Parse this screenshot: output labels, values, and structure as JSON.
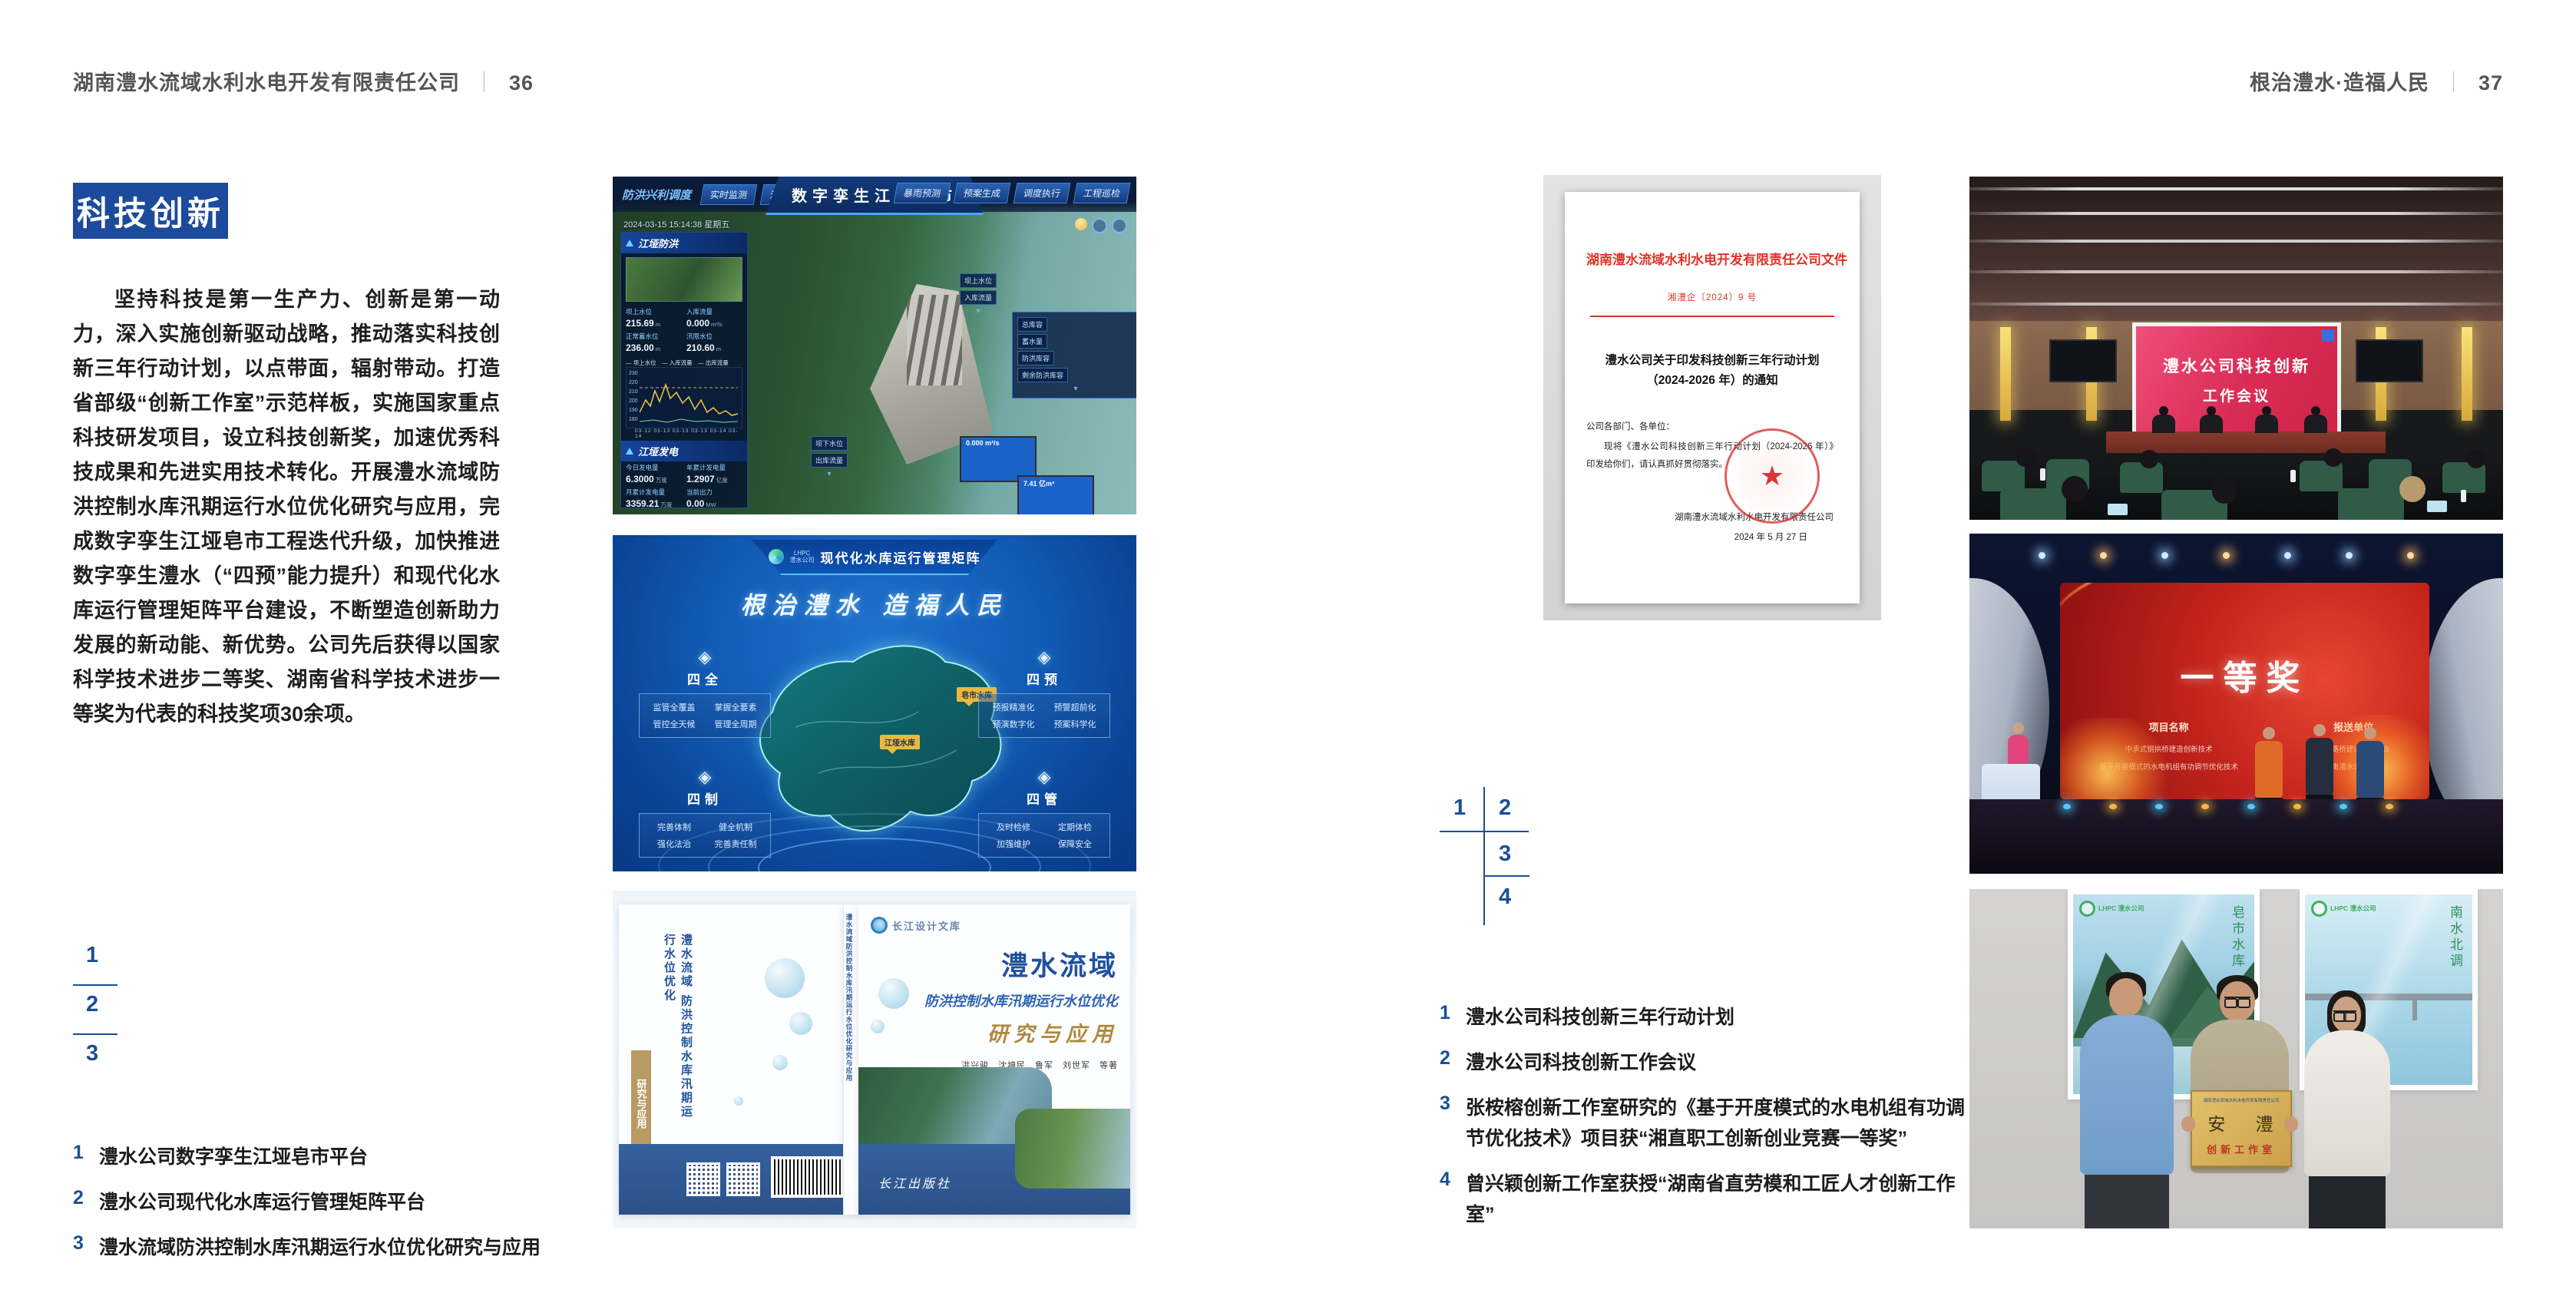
{
  "page": {
    "header_left": {
      "company": "湖南澧水流域水利水电开发有限责任公司",
      "divider": "｜",
      "page_no": "36"
    },
    "header_right": {
      "slogan": "根治澧水·造福人民",
      "divider": "｜",
      "page_no": "37"
    },
    "accent": "#1c4b9d"
  },
  "left_page": {
    "badge": "科技创新",
    "body": "坚持科技是第一生产力、创新是第一动力，深入实施创新驱动战略，推动落实科技创新三年行动计划，以点带面，辐射带动。打造省部级“创新工作室”示范样板，实施国家重点科技研发项目，设立科技创新奖，加速优秀科技成果和先进实用技术转化。开展澧水流域防洪控制水库汛期运行水位优化研究与应用，完成数字孪生江垭皂市工程迭代升级，加快推进数字孪生澧水（“四预”能力提升）和现代化水库运行管理矩阵平台建设，不断塑造创新助力发展的新动能、新优势。公司先后获得以国家科学技术进步二等奖、湖南省科学技术进步一等奖为代表的科技奖项30余项。",
    "index": {
      "n1": "1",
      "n2": "2",
      "n3": "3"
    },
    "captions": [
      {
        "num": "1",
        "text": "澧水公司数字孪生江垭皂市平台"
      },
      {
        "num": "2",
        "text": "澧水公司现代化水库运行管理矩阵平台"
      },
      {
        "num": "3",
        "text": "澧水流域防洪控制水库汛期运行水位优化研究与应用"
      }
    ]
  },
  "right_page": {
    "index": {
      "n1": "1",
      "n2": "2",
      "n3": "3",
      "n4": "4"
    },
    "captions": [
      {
        "num": "1",
        "text": "澧水公司科技创新三年行动计划"
      },
      {
        "num": "2",
        "text": "澧水公司科技创新工作会议"
      },
      {
        "num": "3",
        "text": "张桉榕创新工作室研究的《基于开度模式的水电机组有功调节优化技术》项目获“湘直职工创新创业竞赛一等奖”"
      },
      {
        "num": "4",
        "text": "曾兴颖创新工作室获授“湖南省直劳模和工匠人才创新工作室”"
      }
    ]
  },
  "fig_twin": {
    "title": "数字孪生江垭皂市",
    "mode_label": "防洪兴利调度",
    "nav": [
      "实时监测",
      "洪水预报",
      "防洪预警",
      "暴雨预测",
      "预案生成",
      "调度执行",
      "工程巡检"
    ],
    "datetime": "2024-03-15 15:14:38 星期五",
    "panel_flood_title": "江垭防洪",
    "flood_stats": [
      {
        "label": "坝上水位",
        "value": "215.69",
        "unit": "m"
      },
      {
        "label": "入库流量",
        "value": "0.000",
        "unit": "m³/s"
      },
      {
        "label": "正常蓄水位",
        "value": "236.00",
        "unit": "m"
      },
      {
        "label": "汛限水位",
        "value": "210.60",
        "unit": "m"
      }
    ],
    "legend": "— 坝上水位　— 入库流量　— 出库流量",
    "chart": {
      "y_axis": "230\n220\n210\n200\n190\n180",
      "x_axis": "03-12  03-13  03-13  03-13  03-14  03-14"
    },
    "panel_gen_title": "江垭发电",
    "gen_stats": [
      {
        "label": "今日发电量",
        "value": "6.3000",
        "unit": "万度"
      },
      {
        "label": "年累计发电量",
        "value": "1.2907",
        "unit": "亿度"
      },
      {
        "label": "月累计发电量",
        "value": "3359.21",
        "unit": "万度"
      },
      {
        "label": "当前出力",
        "value": "0.00",
        "unit": "MW"
      }
    ],
    "tag_up": [
      {
        "label": "坝上水位",
        "value": "236.69 m"
      },
      {
        "label": "入库流量",
        "value": "0.000 m³/s"
      }
    ],
    "tag_res": [
      {
        "label": "总库容",
        "value": "17.41 亿m³"
      },
      {
        "label": "蓄水量",
        "value": "8.16 亿m³"
      },
      {
        "label": "防洪库容",
        "value": "7.41 亿m³"
      },
      {
        "label": "剩余防洪库容",
        "value": "7.41 亿m³"
      }
    ],
    "tag_down": [
      {
        "label": "坝下水位",
        "value": "136.78 m"
      },
      {
        "label": "出库流量",
        "value": "65.8 m³/s"
      }
    ]
  },
  "fig_matrix": {
    "logo_text": "LHPC",
    "logo_sub": "澧水公司",
    "title": "现代化水库运行管理矩阵",
    "slogan": "根治澧水 造福人民",
    "groups": [
      {
        "name": "四全",
        "i1": "监管全覆盖",
        "i2": "掌握全要素",
        "i3": "管控全天候",
        "i4": "管理全周期"
      },
      {
        "name": "四预",
        "i1": "预报精准化",
        "i2": "预警超前化",
        "i3": "预演数字化",
        "i4": "预案科学化"
      },
      {
        "name": "四制",
        "i1": "完善体制",
        "i2": "健全机制",
        "i3": "强化法治",
        "i4": "完善责任制"
      },
      {
        "name": "四管",
        "i1": "及时检修",
        "i2": "定期体检",
        "i3": "加强维护",
        "i4": "保障安全"
      }
    ],
    "pin1": "江垭水库",
    "pin2": "皂市水库"
  },
  "fig_book": {
    "series": "长江设计文库",
    "back_title": "澧水流域 防洪控制水库汛期运行水位优化",
    "back_tail": "研究与应用",
    "spine": "澧水流域防洪控制水库汛期运行水位优化研究与应用",
    "title1": "澧水流域",
    "title2": "防洪控制水库汛期运行水位优化",
    "title3": "研究与应用",
    "authors": "洪兴骏　沈坤民　鲁军　刘世军　等著",
    "publisher": "长江出版社"
  },
  "fig_doc": {
    "masthead": "湖南澧水流域水利水电开发有限责任公司文件",
    "doc_no": "湘澧企〔2024〕9 号",
    "title1": "澧水公司关于印发科技创新三年行动计划",
    "title2": "（2024-2026 年）的通知",
    "salutation": "公司各部门、各单位：",
    "body": "现将《澧水公司科技创新三年行动计划（2024-2026 年）》印发给你们，请认真抓好贯彻落实。",
    "signer": "湖南澧水流域水利水电开发有限责任公司",
    "date": "2024 年 5 月 27 日",
    "seal_star": "★"
  },
  "fig_meeting": {
    "screen1": "澧水公司科技创新",
    "screen2": "工作会议"
  },
  "fig_award": {
    "headline": "一等奖",
    "col1_title": "项目名称",
    "col2_title": "报送单位",
    "p1": "中承式钢拱桥建造创新技术",
    "p2": "基于开度模式的水电机组有功调节优化技术",
    "u1": "湖南路桥建设集团工会",
    "u2": "湖南澧水公司工会"
  },
  "fig_studio": {
    "plaque_org": "湖南澧水流域水利水电开发有限责任公司",
    "plaque_name": "安 澧",
    "plaque_sub": "创新工作室",
    "poster1_logo": "LHPC 澧水公司",
    "poster2_logo": "LHPC 澧水公司",
    "poster1_caption": "皂市水库",
    "poster2_caption": "南水北调"
  }
}
